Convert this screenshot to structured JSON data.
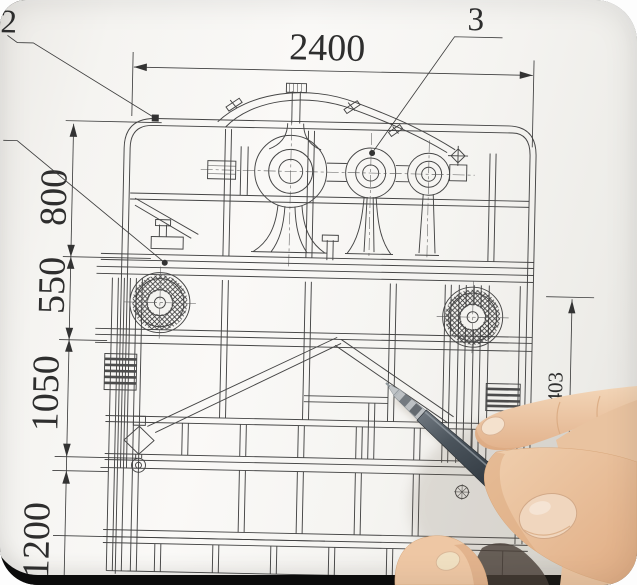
{
  "drawing": {
    "top_dimension": "2400",
    "left_dimensions": [
      "800",
      "550",
      "1050",
      "1200"
    ],
    "right_dimension": "1403",
    "callout_left": "2",
    "callout_right": "3"
  },
  "colors": {
    "ink": "#454545",
    "paper": "#f5f4f1",
    "pen_barrel": "#4b545c",
    "pen_grip": "#b6bbbf",
    "skin": "#eac9a8",
    "photo_background": "#101010",
    "surface_light": "#c6c5c2"
  }
}
